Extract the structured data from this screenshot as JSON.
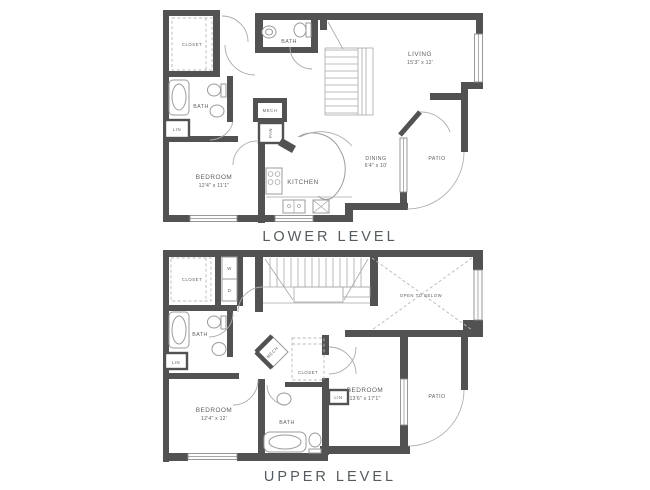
{
  "colors": {
    "wall": "#525252",
    "line": "#9b9b9b",
    "text": "#5d6266"
  },
  "lower": {
    "title": "LOWER LEVEL",
    "closet": "CLOSET",
    "bath1": "BATH",
    "living_name": "LIVING",
    "living_dims": "15'3\" x 12'",
    "bath2": "BATH",
    "lin": "LIN",
    "mech": "MECH",
    "pan": "PAN",
    "bedroom_name": "BEDROOM",
    "bedroom_dims": "12'4\" x 11'1\"",
    "kitchen": "KITCHEN",
    "dining_name": "DINING",
    "dining_dims": "6'4\" x 10'",
    "patio": "PATIO"
  },
  "upper": {
    "title": "UPPER LEVEL",
    "closet1": "CLOSET",
    "washer": "W",
    "dryer": "D",
    "bath1": "BATH",
    "lin1": "LIN",
    "mech": "MECH",
    "closet2": "CLOSET",
    "open_to_below": "OPEN TO BELOW",
    "bedroom1_name": "BEDROOM",
    "bedroom1_dims": "12'4\" x 12'",
    "bath2": "BATH",
    "lin2": "LIN",
    "bedroom2_name": "BEDROOM",
    "bedroom2_dims": "13'6\" x 17'1\"",
    "patio": "PATIO"
  }
}
